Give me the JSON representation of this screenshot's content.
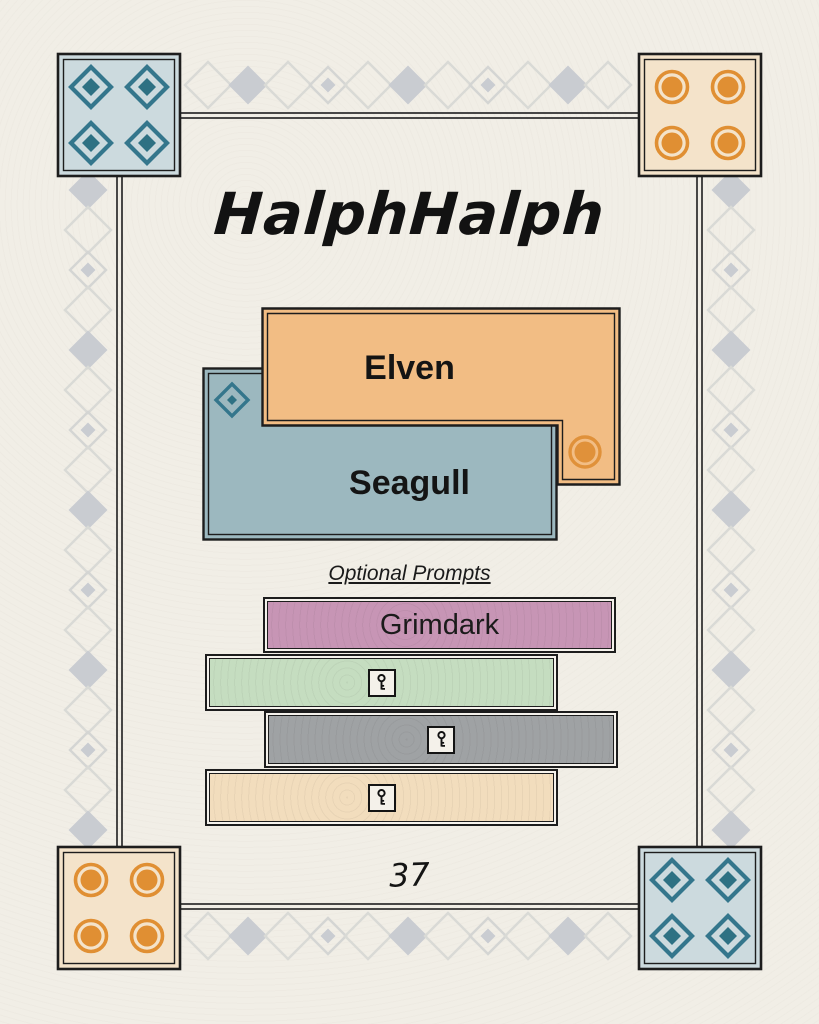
{
  "header": {
    "title": "HalphHalph"
  },
  "cards": {
    "elven": {
      "label": "Elven",
      "color": "#f2bd84",
      "icon": "circle-icon"
    },
    "seagull": {
      "label": "Seagull",
      "color": "#9cb8bf",
      "icon": "diamond-icon"
    }
  },
  "prompts": {
    "heading": "Optional Prompts",
    "items": [
      {
        "label": "Grimdark",
        "locked": false,
        "color": "#c795b5"
      },
      {
        "locked": true,
        "icon": "key-icon",
        "color": "#c5ddc0"
      },
      {
        "locked": true,
        "icon": "key-icon",
        "color": "#9fa2a4"
      },
      {
        "locked": true,
        "icon": "key-icon",
        "color": "#f2ddbd"
      }
    ]
  },
  "footer": {
    "page_number": "37"
  },
  "decor": {
    "corner_icons": {
      "top_left": "diamond-grid",
      "top_right": "circle-grid",
      "bottom_left": "circle-grid",
      "bottom_right": "diamond-grid"
    },
    "colors": {
      "paper": "#f1eee6",
      "border_ink": "#1d1d1d",
      "accent_teal": "#2e7183",
      "accent_orange": "#e08f33",
      "corner_blue": "#ccdade",
      "corner_peach": "#f4e3ca",
      "chain_gray": "#c9ccd1"
    }
  }
}
